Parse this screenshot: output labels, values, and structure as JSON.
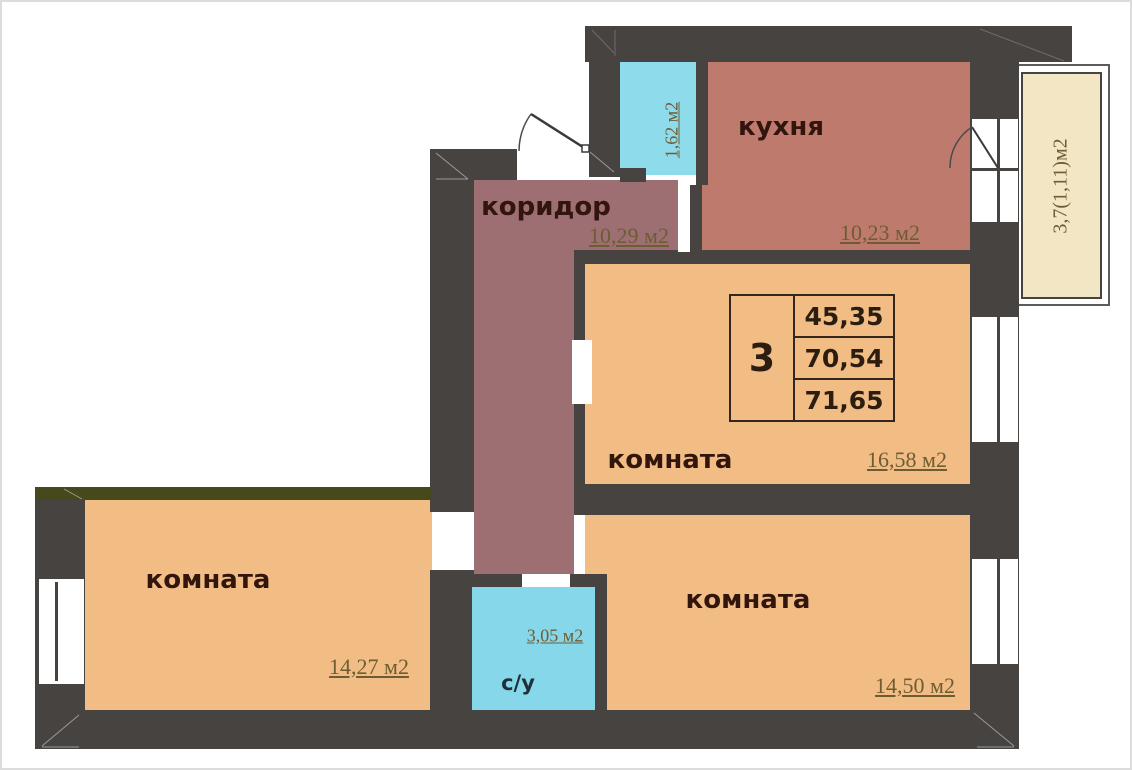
{
  "plan_title": "apartment-floor-plan",
  "rooms": {
    "kitchen": {
      "name": "кухня",
      "area": "10,23 м2"
    },
    "corridor": {
      "name": "коридор",
      "area": "10,29 м2"
    },
    "room_top": {
      "name": "комната",
      "area": "16,58 м2"
    },
    "room_left": {
      "name": "комната",
      "area": "14,27 м2"
    },
    "room_right": {
      "name": "комната",
      "area": "14,50 м2"
    },
    "bathroom": {
      "name": "с/у",
      "area": "3,05 м2"
    },
    "storage": {
      "area": "1,62 м2"
    },
    "balcony": {
      "area": "3,7(1,11)м2"
    }
  },
  "info_box": {
    "rooms_count": "3",
    "values": [
      "45,35",
      "70,54",
      "71,65"
    ]
  },
  "colors": {
    "wall": "#474341",
    "kitchen_fill": "#bf7a6e",
    "corridor_fill": "#9d6e72",
    "room_fill": "#f2bd85",
    "wet_room_fill": "#8edbeb",
    "bathroom_fill": "#86d7e9",
    "balcony_fill": "#f3e6c4",
    "accent_wall": "#46491b",
    "area_text": "#6e5c33",
    "label_text": "#32150c"
  }
}
